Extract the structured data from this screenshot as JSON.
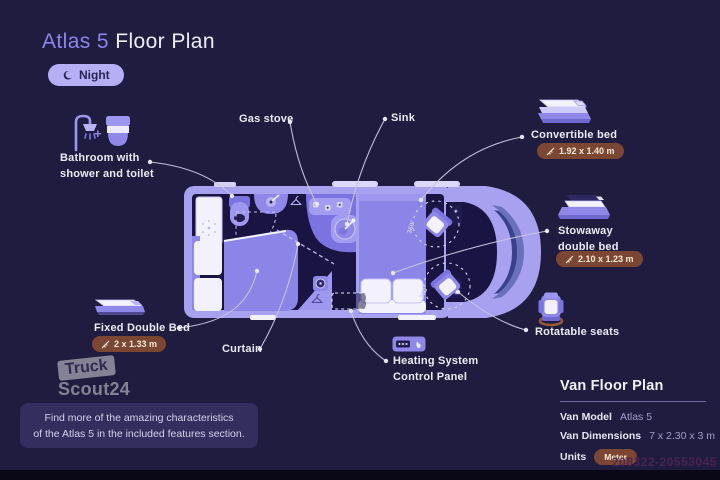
{
  "colors": {
    "background": "#201c40",
    "accent_purple": "#8d85ea",
    "van_body": "#a7a1f0",
    "furniture_light": "#9d97f0",
    "furniture_mid": "#7b74e0",
    "interior_dark": "#191442",
    "badge_brown": "#7c4634",
    "badge_text": "#fbe9d8",
    "label_text": "#eceaf8"
  },
  "header": {
    "title_accent": "Atlas 5",
    "title_rest": " Floor Plan",
    "mode_badge": {
      "icon": "moon-icon",
      "label": "Night"
    }
  },
  "callouts": {
    "bathroom": {
      "icons": [
        "shower-icon",
        "plus-sign",
        "toilet-icon"
      ],
      "plus": "+",
      "line1": "Bathroom with",
      "line2": "shower and toilet"
    },
    "gas_stove": {
      "label": "Gas stove"
    },
    "sink": {
      "label": "Sink"
    },
    "convertible_bed": {
      "icon": "convertible-bed-icon",
      "label": "Convertible bed",
      "dimensions": "1.92 x 1.40 m"
    },
    "stowaway_bed": {
      "icon": "stowaway-bed-icon",
      "line1": "Stowaway",
      "line2": "double bed",
      "dimensions": "2.10 x 1.23 m"
    },
    "fixed_bed": {
      "icon": "fixed-bed-icon",
      "label": "Fixed Double Bed",
      "dimensions": "2 x 1.33 m"
    },
    "curtain": {
      "label": "Curtain"
    },
    "heating": {
      "icon": "control-panel-icon",
      "line1": "Heating System",
      "line2": "Control Panel"
    },
    "rotatable_seats": {
      "icon": "swivel-seat-icon",
      "label": "Rotatable seats"
    }
  },
  "plan": {
    "seat_rotation_label": "360°"
  },
  "spec_panel": {
    "title": "Van Floor Plan",
    "rows": [
      {
        "label": "Van Model",
        "value": "Atlas 5"
      },
      {
        "label": "Van Dimensions",
        "value": "7 x 2.30 x 3 m"
      },
      {
        "label": "Units",
        "value": "Meter"
      }
    ]
  },
  "watermark_logo": {
    "line1": "Truck",
    "line2": "Scout24"
  },
  "footer_note": {
    "line1": "Find more of the amazing characteristics",
    "line2": "of the Atlas 5 in the included features section."
  },
  "watermark_id": "208322-20553045"
}
